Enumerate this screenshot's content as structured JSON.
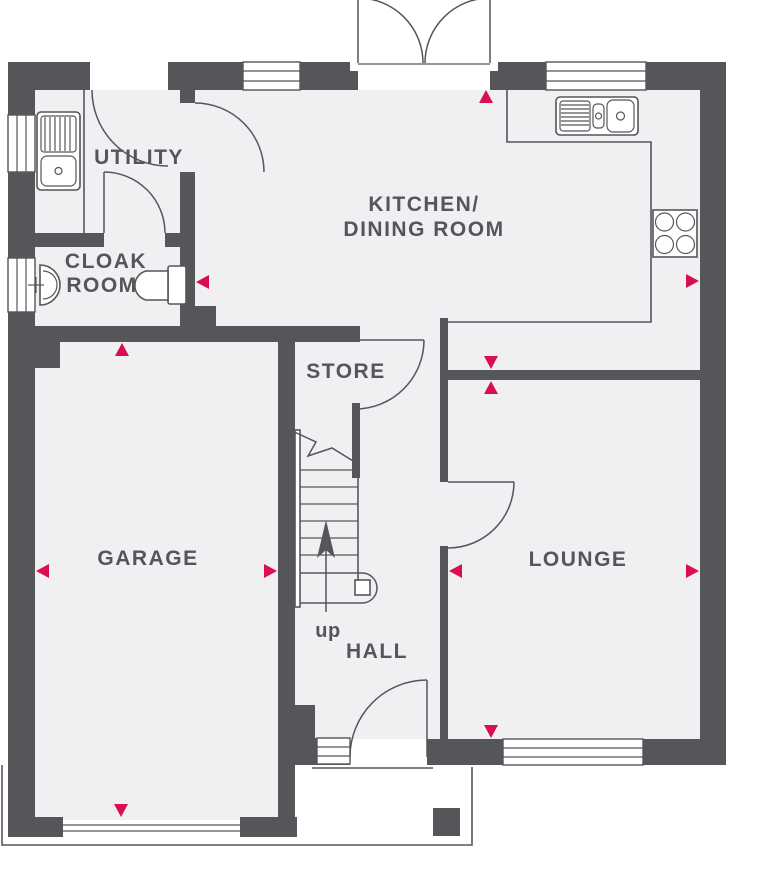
{
  "plan": {
    "rooms": {
      "utility": "UTILITY",
      "cloak_line1": "CLOAK",
      "cloak_line2": "ROOM",
      "kitchen_line1": "KITCHEN/",
      "kitchen_line2": "DINING ROOM",
      "store": "STORE",
      "garage": "GARAGE",
      "hall": "HALL",
      "lounge": "LOUNGE",
      "stairs_direction": "up"
    },
    "colors": {
      "wall": "#55565a",
      "floor": "#f0f0f2",
      "accent": "#d8104f",
      "line": "#55565a",
      "background": "#ffffff"
    },
    "fixtures": [
      "french-doors",
      "utility-external-door",
      "utility-sink-drainer",
      "utility-counter",
      "cloakroom-basin",
      "cloakroom-wc",
      "kitchen-sink-drainer",
      "kitchen-counter",
      "hob",
      "staircase",
      "store-door",
      "lounge-door",
      "front-door",
      "garage-door",
      "porch-pillar",
      "sidelight-window"
    ],
    "markers": [
      {
        "room": "kitchen-dining",
        "wall": "top",
        "direction": "up"
      },
      {
        "room": "kitchen-dining",
        "wall": "right",
        "direction": "right"
      },
      {
        "room": "cloakroom",
        "wall": "right",
        "direction": "left"
      },
      {
        "room": "kitchen-lounge-divider",
        "wall": "middle",
        "direction": "down"
      },
      {
        "room": "kitchen-lounge-divider",
        "wall": "middle",
        "direction": "up"
      },
      {
        "room": "garage",
        "wall": "top",
        "direction": "up"
      },
      {
        "room": "garage",
        "wall": "left",
        "direction": "left"
      },
      {
        "room": "garage",
        "wall": "right",
        "direction": "right"
      },
      {
        "room": "garage",
        "wall": "bottom",
        "direction": "down"
      },
      {
        "room": "lounge",
        "wall": "left",
        "direction": "left"
      },
      {
        "room": "lounge",
        "wall": "right",
        "direction": "right"
      },
      {
        "room": "lounge",
        "wall": "bottom",
        "direction": "down"
      }
    ]
  }
}
